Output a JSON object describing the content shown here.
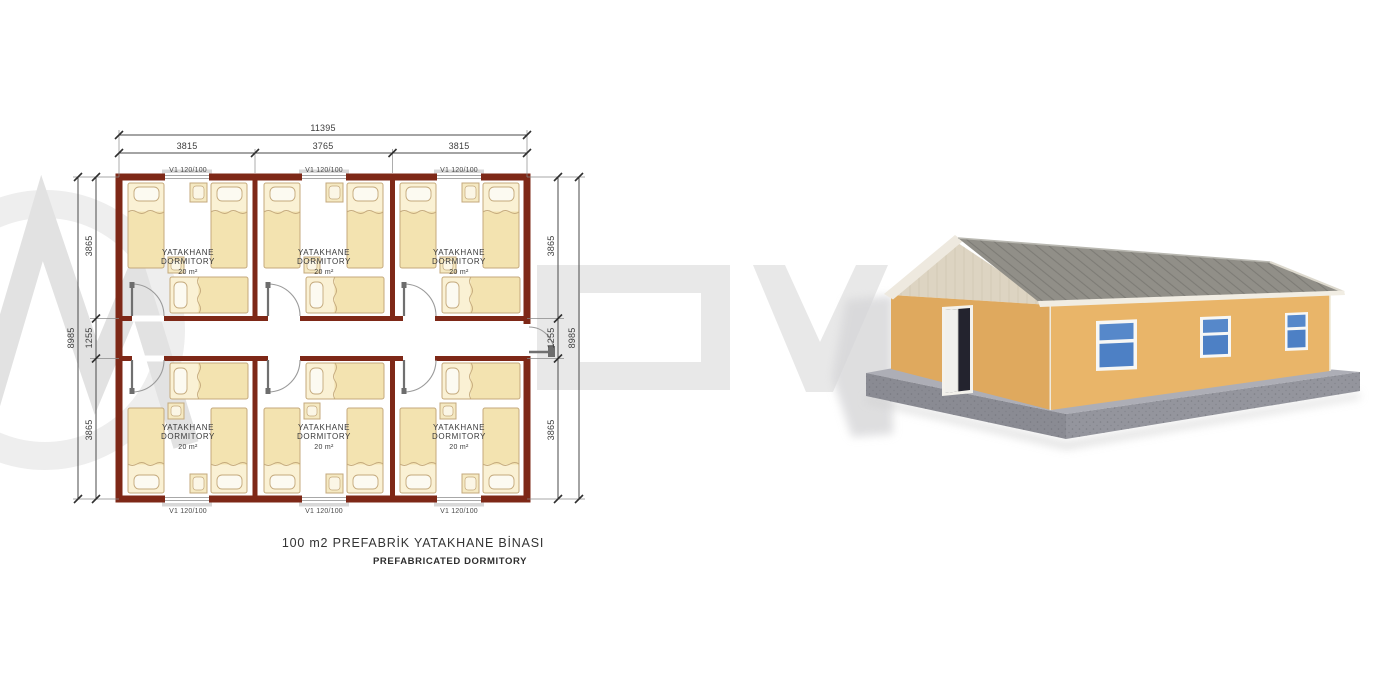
{
  "plan": {
    "title": "100 m2 PREFABRİK YATAKHANE BİNASI",
    "subtitle": "PREFABRICATED DORMITORY",
    "window_label": "V1 120/100",
    "room": {
      "line1": "YATAKHANE",
      "line2": "DORMITORY",
      "area": "20 m²"
    },
    "dims": {
      "total_width": "11395",
      "segments_top": [
        "3815",
        "3765",
        "3815"
      ],
      "total_height": "8985",
      "segments_side": [
        "3865",
        "1255",
        "3865"
      ]
    }
  },
  "colors": {
    "wall": "#7e2817",
    "bed_body": "#f3e3b0",
    "bed_upper": "#faf1d4",
    "building_wall": "#e9b569",
    "gable_wall": "#dfa95e",
    "gable_panel": "#ddd4c2",
    "roof": "#8e8d86",
    "window_glass": "#4d80c5",
    "base_concrete": "#9b9ca4",
    "watermark": "#e9e9e9"
  }
}
